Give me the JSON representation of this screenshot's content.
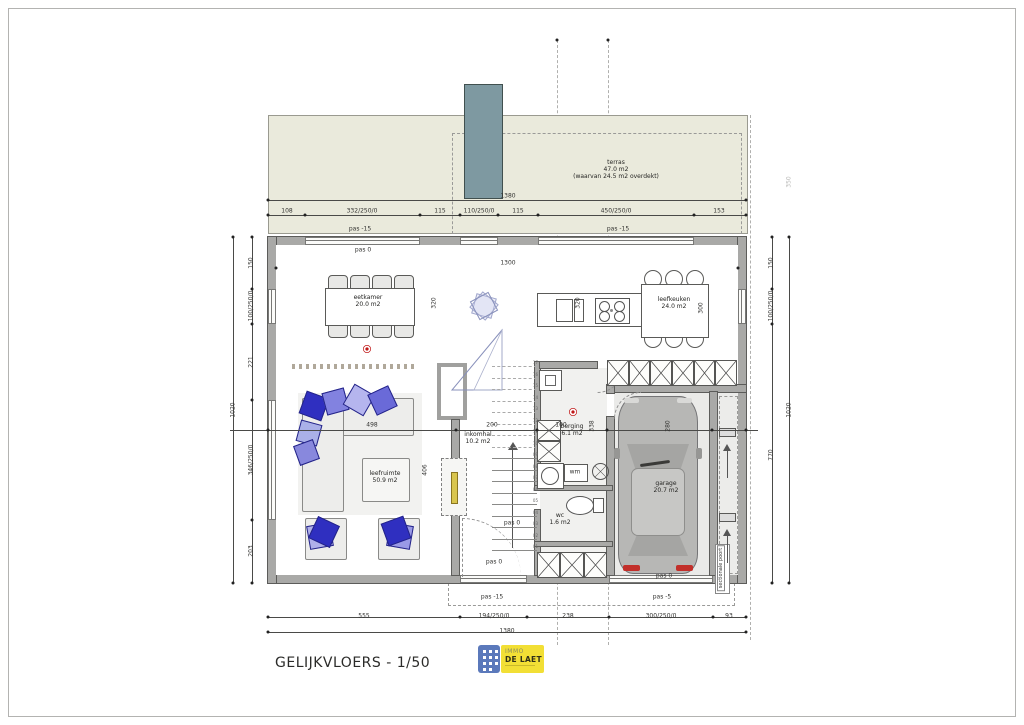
{
  "title": "GELIJKVLOERS - 1/50",
  "logo": {
    "immo": "IMMO",
    "delaet": "DE LAET"
  },
  "rooms": [
    {
      "id": "terras",
      "lines": [
        "terras",
        "47.0 m2",
        "(waarvan 24.5 m2 overdekt)"
      ],
      "x": 616,
      "y": 170
    },
    {
      "id": "eetkamer",
      "lines": [
        "eetkamer",
        "20.0 m2"
      ],
      "x": 368,
      "y": 301
    },
    {
      "id": "leefkeuken",
      "lines": [
        "leefkeuken",
        "24.0 m2"
      ],
      "x": 674,
      "y": 303
    },
    {
      "id": "leefruimte",
      "lines": [
        "leefruimte",
        "50.9 m2"
      ],
      "x": 385,
      "y": 477
    },
    {
      "id": "inkomhal",
      "lines": [
        "inkomhal",
        "10.2 m2"
      ],
      "x": 478,
      "y": 438
    },
    {
      "id": "berging",
      "lines": [
        "berging",
        "6.1 m2"
      ],
      "x": 572,
      "y": 430
    },
    {
      "id": "wc",
      "lines": [
        "wc",
        "1.6 m2"
      ],
      "x": 560,
      "y": 519
    },
    {
      "id": "garage",
      "lines": [
        "garage",
        "20.7 m2"
      ],
      "x": 666,
      "y": 487
    }
  ],
  "annotations": [
    {
      "t": "1380",
      "x": 508,
      "y": 196
    },
    {
      "t": "108",
      "x": 287,
      "y": 211
    },
    {
      "t": "332/250/0",
      "x": 362,
      "y": 211
    },
    {
      "t": "115",
      "x": 440,
      "y": 211
    },
    {
      "t": "110/250/0",
      "x": 479,
      "y": 211
    },
    {
      "t": "115",
      "x": 518,
      "y": 211
    },
    {
      "t": "450/250/0",
      "x": 616,
      "y": 211
    },
    {
      "t": "153",
      "x": 719,
      "y": 211
    },
    {
      "t": "pas -15",
      "x": 360,
      "y": 229
    },
    {
      "t": "pas -15",
      "x": 618,
      "y": 229
    },
    {
      "t": "pas 0",
      "x": 363,
      "y": 250
    },
    {
      "t": "1300",
      "x": 508,
      "y": 263
    },
    {
      "t": "320",
      "x": 434,
      "y": 303,
      "v": 1
    },
    {
      "t": "320",
      "x": 578,
      "y": 303,
      "v": 1
    },
    {
      "t": "300",
      "x": 701,
      "y": 308,
      "v": 1
    },
    {
      "t": "498",
      "x": 372,
      "y": 425
    },
    {
      "t": "200",
      "x": 492,
      "y": 425
    },
    {
      "t": "100",
      "x": 561,
      "y": 425
    },
    {
      "t": "338",
      "x": 592,
      "y": 426,
      "v": 1
    },
    {
      "t": "406",
      "x": 425,
      "y": 470,
      "v": 1
    },
    {
      "t": "280",
      "x": 668,
      "y": 426,
      "v": 1
    },
    {
      "t": "pas 0",
      "x": 512,
      "y": 523
    },
    {
      "t": "pas 0",
      "x": 494,
      "y": 562
    },
    {
      "t": "pas 0",
      "x": 664,
      "y": 576
    },
    {
      "t": "pas -15",
      "x": 492,
      "y": 597
    },
    {
      "t": "pas -5",
      "x": 662,
      "y": 597
    },
    {
      "t": "555",
      "x": 364,
      "y": 616
    },
    {
      "t": "194/250/0",
      "x": 494,
      "y": 616
    },
    {
      "t": "238",
      "x": 568,
      "y": 616
    },
    {
      "t": "300/250/0",
      "x": 661,
      "y": 616
    },
    {
      "t": "93",
      "x": 729,
      "y": 616
    },
    {
      "t": "1380",
      "x": 507,
      "y": 631
    },
    {
      "t": "150",
      "x": 251,
      "y": 263,
      "v": 1
    },
    {
      "t": "100/250/0",
      "x": 251,
      "y": 306,
      "v": 1
    },
    {
      "t": "221",
      "x": 251,
      "y": 362,
      "v": 1
    },
    {
      "t": "346/250/0",
      "x": 251,
      "y": 460,
      "v": 1
    },
    {
      "t": "203",
      "x": 251,
      "y": 551,
      "v": 1
    },
    {
      "t": "1020",
      "x": 233,
      "y": 410,
      "v": 1
    },
    {
      "t": "150",
      "x": 771,
      "y": 263,
      "v": 1
    },
    {
      "t": "100/250/0",
      "x": 771,
      "y": 306,
      "v": 1
    },
    {
      "t": "770",
      "x": 771,
      "y": 455,
      "v": 1
    },
    {
      "t": "1020",
      "x": 789,
      "y": 410,
      "v": 1
    },
    {
      "t": "350",
      "x": 789,
      "y": 182,
      "v": 1,
      "cls": "faint"
    },
    {
      "t": "wm",
      "x": 575,
      "y": 472
    },
    {
      "t": "sectionale poort",
      "x": 721,
      "y": 568,
      "v": 1,
      "cls": "boxed"
    }
  ],
  "dots": [
    [
      268,
      200
    ],
    [
      746,
      200
    ],
    [
      268,
      215
    ],
    [
      305,
      215
    ],
    [
      420,
      215
    ],
    [
      460,
      215
    ],
    [
      498,
      215
    ],
    [
      538,
      215
    ],
    [
      694,
      215
    ],
    [
      746,
      215
    ],
    [
      276,
      268
    ],
    [
      738,
      268
    ],
    [
      268,
      430
    ],
    [
      456,
      430
    ],
    [
      537,
      430
    ],
    [
      607,
      430
    ],
    [
      712,
      430
    ],
    [
      746,
      430
    ],
    [
      268,
      617
    ],
    [
      460,
      617
    ],
    [
      527,
      617
    ],
    [
      609,
      617
    ],
    [
      713,
      617
    ],
    [
      746,
      617
    ],
    [
      268,
      632
    ],
    [
      746,
      632
    ],
    [
      233,
      237
    ],
    [
      233,
      583
    ],
    [
      252,
      237
    ],
    [
      252,
      289
    ],
    [
      252,
      324
    ],
    [
      252,
      400
    ],
    [
      252,
      520
    ],
    [
      252,
      583
    ],
    [
      772,
      237
    ],
    [
      772,
      289
    ],
    [
      772,
      324
    ],
    [
      772,
      583
    ],
    [
      789,
      237
    ],
    [
      789,
      583
    ],
    [
      557,
      40
    ],
    [
      608,
      40
    ]
  ],
  "stairs": {
    "numbers": [
      "01",
      "02",
      "03",
      "04",
      "05",
      "06",
      "07",
      "08",
      "09",
      "10",
      "11",
      "12",
      "13",
      "14",
      "15",
      "16",
      "17"
    ]
  }
}
